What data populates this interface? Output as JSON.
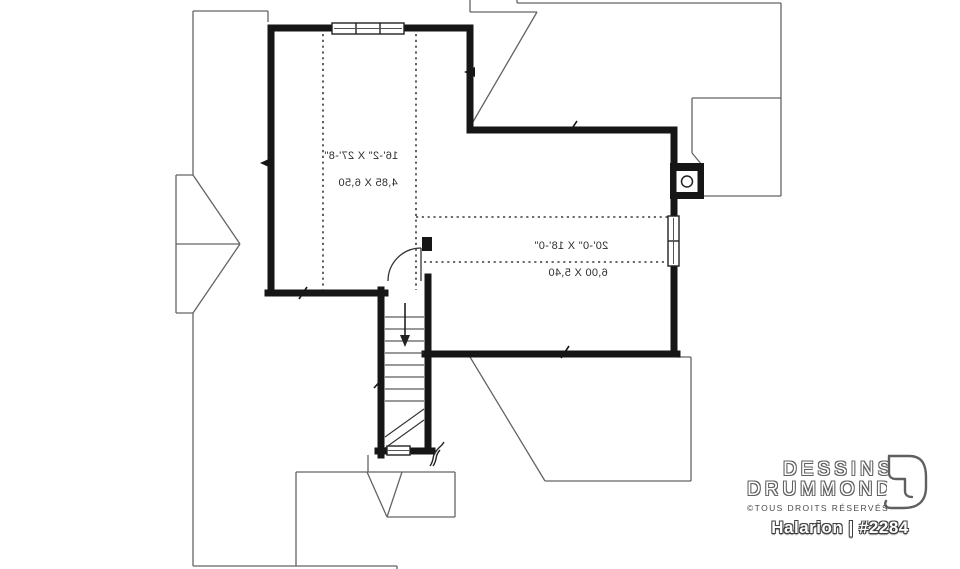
{
  "plan": {
    "title": "Halarion | #2284"
  },
  "brand": {
    "name_line1": "DESSINS",
    "name_line2": "DRUMMOND",
    "rights": "©TOUS DROITS RÉSERVÉS"
  },
  "rooms": [
    {
      "id": "bonus-space-left",
      "dims_imperial": "16'-2\" X 27'-8\"",
      "dims_metric": "4,85 X 6,50"
    },
    {
      "id": "bonus-space-right",
      "dims_imperial": "20'-0\" X 18'-0\"",
      "dims_metric": "6,00 X 5,40"
    }
  ],
  "icons": [
    "chimney-flue-icon",
    "stair-down-arrow-icon",
    "door-swing-icon",
    "triple-window-icon",
    "double-window-icon",
    "stair-window-icon",
    "break-line-icon",
    "drummond-logo-icon"
  ],
  "colors": {
    "background": "#ffffff",
    "wall": "#161616",
    "thin_roof_line": "#646464",
    "dotted_line": "#3c3c3c",
    "label_text": "#2e2e2e",
    "logo_outline": "#5f5f5f"
  }
}
